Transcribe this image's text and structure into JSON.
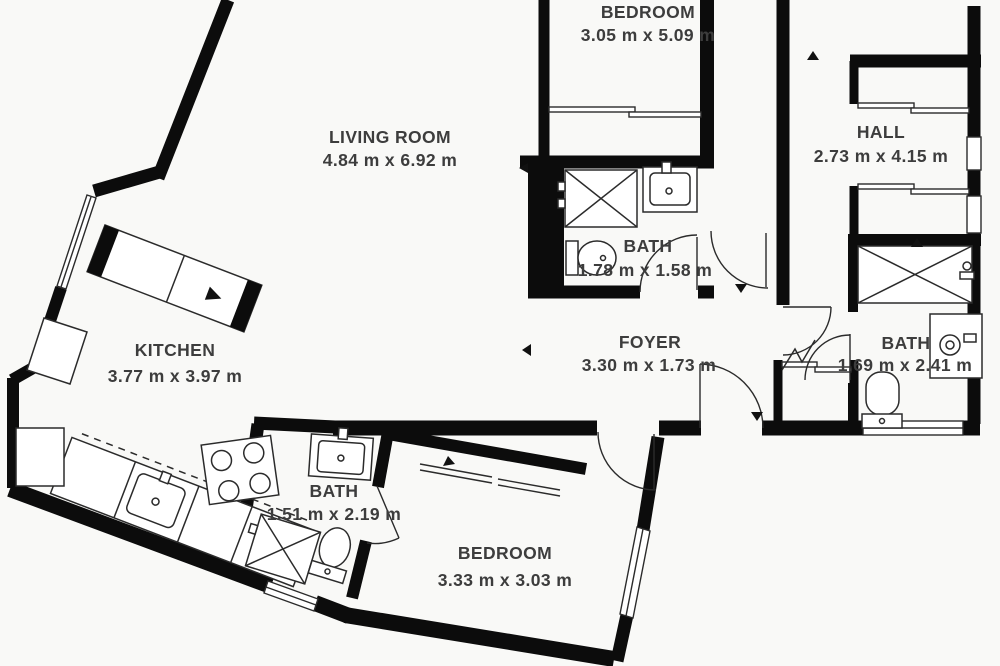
{
  "palette": {
    "background": "#f9f9f7",
    "wall": "#0c0c0c",
    "line": "#2b2b2b",
    "text": "#3d3d3d"
  },
  "rooms": [
    {
      "key": "bedroom-top",
      "name": "BEDROOM",
      "dims": "3.05 m x 5.09 m"
    },
    {
      "key": "living-room",
      "name": "LIVING ROOM",
      "dims": "4.84 m x 6.92 m"
    },
    {
      "key": "hall",
      "name": "HALL",
      "dims": "2.73 m x 4.15 m"
    },
    {
      "key": "bath-middle",
      "name": "BATH",
      "dims": "1.78 m x 1.58 m"
    },
    {
      "key": "kitchen",
      "name": "KITCHEN",
      "dims": "3.77 m x 3.97 m"
    },
    {
      "key": "foyer",
      "name": "FOYER",
      "dims": "3.30 m x 1.73 m"
    },
    {
      "key": "bath-right",
      "name": "BATH",
      "dims": "1.69 m x 2.41 m"
    },
    {
      "key": "bath-small",
      "name": "BATH",
      "dims": "1.51 m x 2.19 m"
    },
    {
      "key": "bedroom-bottom",
      "name": "BEDROOM",
      "dims": "3.33 m x 3.03 m"
    }
  ],
  "fixtures": [
    "shower",
    "sink",
    "toilet",
    "washing-machine",
    "stove",
    "kitchen-counter",
    "wardrobe-closet",
    "sliding-door-closet",
    "window",
    "door-swing"
  ]
}
